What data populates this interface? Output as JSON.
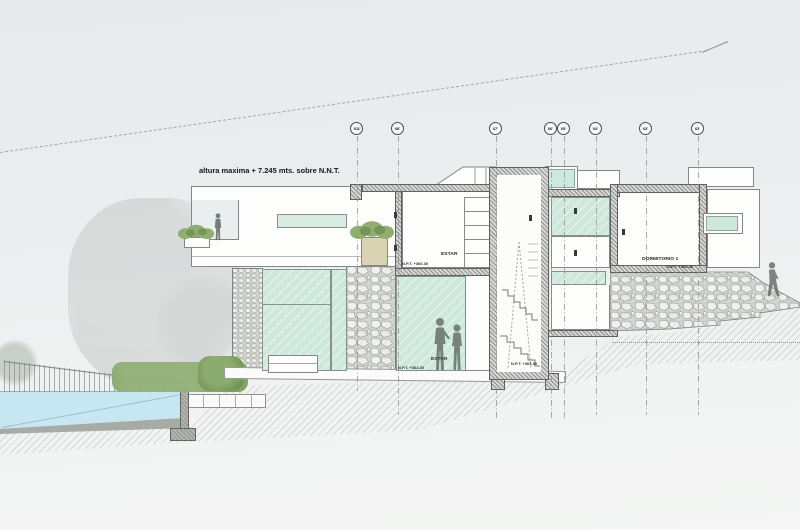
{
  "drawing": {
    "annotations": {
      "max_height": "altura maxima + 7.245 mts. sobre N.N.T."
    },
    "grid_axes": [
      {
        "label": "X11'"
      },
      {
        "label": "X8'"
      },
      {
        "label": "X7'"
      },
      {
        "label": "X6'"
      },
      {
        "label": "X5'"
      },
      {
        "label": "X4'"
      },
      {
        "label": "X3'"
      },
      {
        "label": "X2'"
      }
    ],
    "rooms": {
      "estar_upper": {
        "name": "ESTAR",
        "level": "N.P.T. +366.30"
      },
      "estar_lower": {
        "name": "ESTAR",
        "level": "N.P.T. +363.30"
      },
      "stair": {
        "level": "N.P.T. +363.30"
      },
      "dormitorio1": {
        "name": "DORMITORIO 1",
        "level": "N.P.T. +366.40"
      }
    },
    "colors": {
      "glass": "#cfe8dc",
      "water": "#c6e6f2",
      "vegetation": "#85a369",
      "stone_joint": "#969a96"
    }
  }
}
